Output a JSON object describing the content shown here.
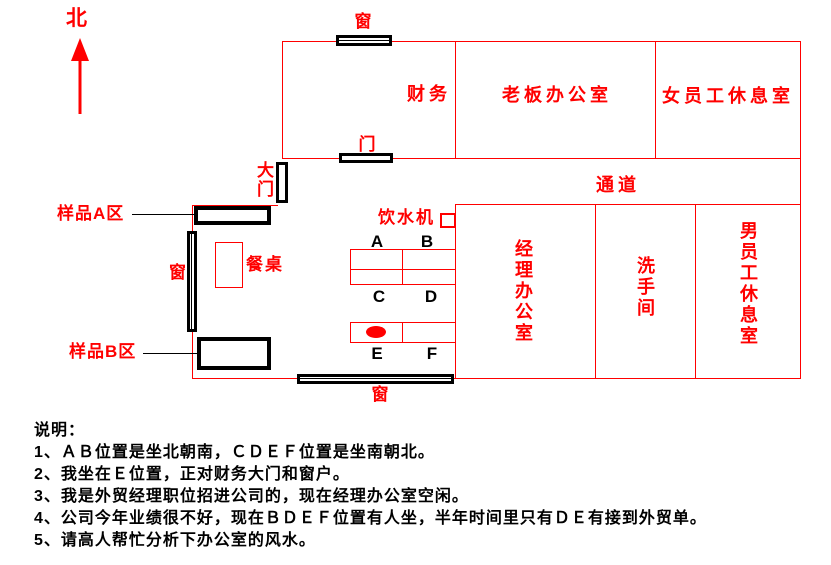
{
  "compass": {
    "north": "北"
  },
  "rooms": {
    "finance": "财务",
    "boss_office": "老板办公室",
    "female_lounge": "女员工休息室",
    "corridor": "通道",
    "manager_office": "经理办公室",
    "restroom": "洗手间",
    "male_lounge": "男员工休息室"
  },
  "labels": {
    "window_top": "窗",
    "door_finance": "门",
    "main_door": "大门",
    "sample_a": "样品A区",
    "window_left": "窗",
    "dining_table": "餐桌",
    "water_dispenser": "饮水机",
    "sample_b": "样品B区",
    "window_bottom": "窗"
  },
  "desks": {
    "a": "A",
    "b": "B",
    "c": "C",
    "d": "D",
    "e": "E",
    "f": "F"
  },
  "notes": {
    "heading": "说明：",
    "items": [
      "1、ＡＢ位置是坐北朝南，ＣＤＥＦ位置是坐南朝北。",
      "2、我坐在Ｅ位置，正对财务大门和窗户。",
      "3、我是外贸经理职位招进公司的，现在经理办公室空闲。",
      "4、公司今年业绩很不好，现在ＢＤＥＦ位置有人坐，半年时间里只有ＤＥ有接到外贸单。",
      "5、请高人帮忙分析下办公室的风水。"
    ]
  },
  "colors": {
    "line_red": "#ff0000",
    "element_black": "#000000",
    "background": "#ffffff"
  }
}
